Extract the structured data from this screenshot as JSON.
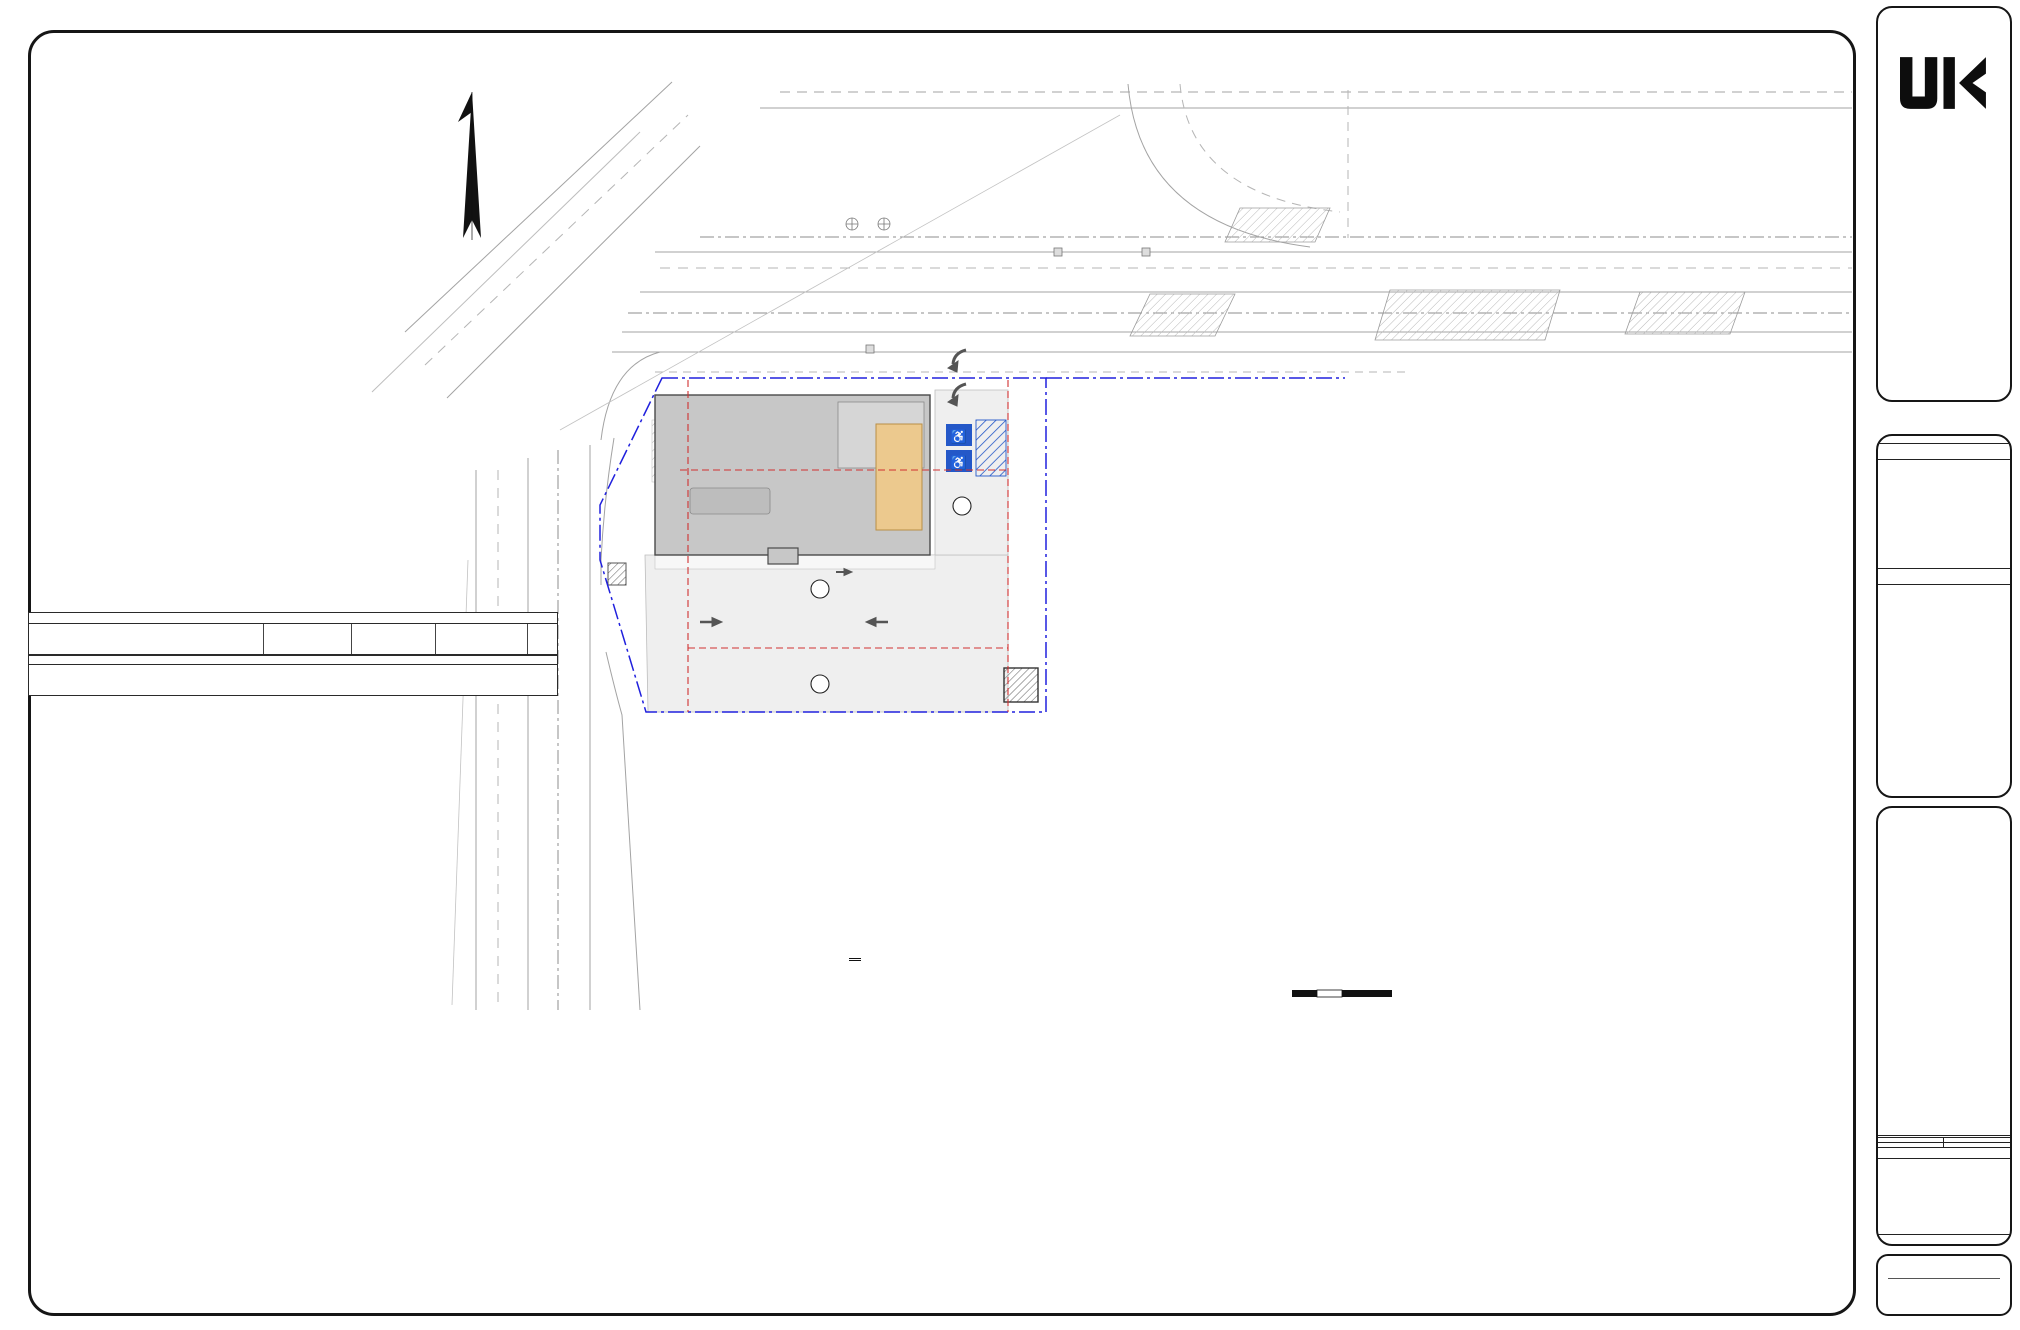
{
  "sheet": {
    "margin_note": "S:\\PROJECT\\KIRPAP21-332 667 E MILTON AVE RAHWAY, NJ\\CAD\\21-332 C-100 SITE EXHIBIT.DWG   PLOTTED: 10/7/2022 9:09 AM",
    "survey": {
      "title": "SURVEY REFERENCE:",
      "items": [
        "BOUNDARY & TOPOGRAPHY INFORMATION IS BASED ON A SURVEY TITLED \"BOUNDARY & TOPOGRAPHIC SURVEY OF 667 EAST MILTON AVENUE, LOT 3.02 IN BLOCK 338 ON TAX MAPS OF CITY OF RAHWAY, UNION COUNTY, NEW JERSEY, PREPARED FOR KIRPA PATEL\", BY PRONESTI SURVEYING, INC., 870 POMPTON AVENUE, SUITE B1, CEDAR GROVE, NJ 07009, DATED 2-14-2022, WITH NO REVISIONS.",
        "VERTICAL DATUM ARE BASED ON NAVD 83."
      ],
      "numbers": [
        "1.",
        "2."
      ]
    },
    "footer": {
      "title": "SCHEMATIC SITE PLAN",
      "scale": "SCALE: 1\"=20'",
      "scalebar": [
        "0",
        "10",
        "20",
        "40"
      ]
    }
  },
  "zoning": {
    "title": "ZONING SCHEDULE",
    "subtitle": "BLOCK 338, LOTS 3.02",
    "zone": "ZONE: B-3 District (Highway Business Zone)",
    "headers": {
      "bulk": "Bulk Regulation",
      "units": "Units",
      "req": "Requirement",
      "exist1": "Existing",
      "exist2": "Lot 3.02",
      "prop": "Proposed"
    },
    "rows": [
      {
        "l": "Principal Permitted Uses",
        "e": "Vacant Lot",
        "p": "Restaurant / Bar",
        "st": "C"
      },
      {
        "g": 1
      },
      {
        "l": "Min. Lot Area",
        "u": "Square Feet",
        "r": "30,000",
        "e": "29,807",
        "p": "29,807",
        "st": "ENC"
      },
      {
        "u": "Acres",
        "r": "0.689",
        "e": "0.684",
        "p": "0.684",
        "st": "-"
      },
      {
        "g": 1
      },
      {
        "l": "Min. Lot Width",
        "u": "Feet",
        "r": "100",
        "e": "150.00",
        "p": "150.00",
        "st": "C"
      },
      {
        "l": "Min. Lot Depth",
        "u": "Feet",
        "r": "200",
        "e": "200.00",
        "p": "200.00",
        "st": "C"
      },
      {
        "g": 1
      },
      {
        "l": "Principal Building (CORNER LOT)",
        "s": 1
      },
      {
        "l": "Min. Front Yard (East Milton Avenue)",
        "u": "Feet",
        "r": "40",
        "e": "-",
        "p": "5.00",
        "st": "V",
        "i": 1,
        "b": 1
      },
      {
        "l": "Min. Front Yard (Paterson Street)",
        "u": "Feet",
        "r": "40",
        "e": "-",
        "p": "25.00",
        "st": "V",
        "i": 1,
        "b": 1
      },
      {
        "l": "Min. Side Yard - One",
        "u": "Feet",
        "r": "20",
        "e": "-",
        "p": "N/A",
        "i": 1
      },
      {
        "l": "Min. Side Yard - Both",
        "u": "Feet",
        "r": "50",
        "e": "-",
        "p": "N/A",
        "i": 1
      },
      {
        "l": "Min. Rear Yard (East Milton Avenue)",
        "u": "Feet",
        "r": "25",
        "e": "-",
        "p": "70.98",
        "st": "C",
        "i": 1
      },
      {
        "l": "Min. Rear Yard (Paterson Street)",
        "u": "Feet",
        "r": "25",
        "e": "-",
        "p": "59.00",
        "st": "C",
        "i": 1
      },
      {
        "l": "Max. Height",
        "u": "Stories",
        "r": "2",
        "e": "-",
        "p": "1",
        "st": "C",
        "i": 1
      },
      {
        "l": "Max. Height",
        "u": "Feet",
        "r": "35",
        "e": "-",
        "p": "18.00",
        "st": "C",
        "i": 1
      },
      {
        "g": 1
      },
      {
        "l": "Accessory Structure (Trash Enclosure)",
        "s": 1
      },
      {
        "l": "Accessory Structure In Front Yard",
        "u": "-",
        "r": "Not Permitted",
        "e": "-",
        "p": "N/A",
        "i": 1
      },
      {
        "l": "Min. Side Yard",
        "u": "Feet",
        "r": "10",
        "e": "-",
        "p": "N/A",
        "i": 1
      },
      {
        "l": "Min. Rear Yard (East Milton Avenue)",
        "u": "Feet",
        "r": "10",
        "e": "-",
        "p": "4.97",
        "st": "V",
        "i": 1,
        "b": 1
      },
      {
        "l": "Min. Rear Yard (Paterson Street)",
        "u": "Feet",
        "r": "10",
        "e": "-",
        "p": "6.99",
        "st": "V",
        "i": 1,
        "b": 1
      },
      {
        "l": "Max. Height",
        "u": "Stories",
        "r": "1",
        "e": "-",
        "p": "1",
        "st": "C",
        "i": 1
      },
      {
        "l": "Max. Height",
        "u": "Feet",
        "r": "15",
        "e": "-",
        "p": "6.00",
        "st": "C",
        "i": 1
      },
      {
        "g": 1
      },
      {
        "l": "Max. Building Coverage",
        "u": "%",
        "r": "35",
        "e": "-",
        "p": "24.73",
        "st": "C"
      },
      {
        "g": 1
      },
      {
        "l": "Max. Impervious Coverage",
        "u": "%",
        "r": "80",
        "e": "-",
        "p": "80.38",
        "st": "V",
        "b": 1
      },
      {
        "g": 1
      },
      {
        "l": "Max. Floor Area Ratio",
        "u": "%",
        "r": "40",
        "e": "-",
        "p": "0.246",
        "st": "C"
      },
      {
        "g": 1
      },
      {
        "l": "Parking Required (2)",
        "r": "67",
        "p": "38",
        "st": "V",
        "b": 1
      }
    ],
    "abbr_title": "Abbreviations",
    "abbreviations": [
      [
        "C",
        "Conforms"
      ],
      [
        "ENC",
        "Existing Non Conformance"
      ],
      [
        "NR",
        "No Requirement"
      ],
      [
        "V",
        "Variance Required"
      ]
    ],
    "notes_title": "Notes:",
    "notes": [
      [
        "1",
        "Codes are based on City of Rahway, Ordinance Section - 421- Attachment 1."
      ],
      [
        "2",
        "Restaurants and eating and drinking establishments 1 per 3 seats, plus 1 per 2 seats in lounge or bar areas."
      ]
    ]
  },
  "titleblock": {
    "firm": {
      "name1": "Jarmel",
      "name2": "Kizel",
      "tag": "ARCHITECTS AND ENGINEERS INC.",
      "addr1": "42 OKNER PARKWAY",
      "addr2": "LIVINGSTON, NEW JERSEY 07039",
      "tel": "TEL: 973-994-9669",
      "fax": "FAX: 973-994-4069",
      "web": "www.jarmelkizel.com",
      "services": [
        "Architecture",
        "Engineering",
        "Interior Design",
        "Implementation Services"
      ],
      "auth1": "NJ State Board Of Architects Authorization No. 161",
      "auth2": "NJ State Board Of Engineers & Land Surveyors Authorization No. GA-278177"
    },
    "issue": {
      "title": "ISSUE",
      "cols": [
        "NO.",
        "DATE",
        "DESCRIPTION",
        "INT."
      ]
    },
    "revision": {
      "title": "REVISION",
      "cols": [
        "NO.",
        "DATE",
        "DESCRIPTION",
        "INT."
      ]
    },
    "principals": {
      "title": "PRINCIPALS",
      "names": [
        "MATTHEW B. JARMEL, AIA, MBA",
        "RICHARD A. JARMEL, PE",
        "IRWIN H. KIZEL, AIA, PP"
      ]
    },
    "architects": {
      "title": "ARCHITECTS & ENGINEERS",
      "names": [
        "RONALD A. BROKENSHIRE, PE",
        "JEROME LESLIE EBEN, FAIA, PP",
        "ARKADIUSZ ERIC CZERW, PE",
        "GERARD P. GESARIO, PE",
        "SAMEH IBRAHEEM, PE",
        "FREDERICK KINCAID, AIA",
        "DAVID L. LESESNE, RA",
        "KAROLINA PODKANOWICZ, AIA",
        "ROBERT B. RICHARDSON, AIA",
        "CHERYL SCHWEIKER, AIA"
      ]
    },
    "project": {
      "label": "Project:",
      "name": "AROOGA'S GRILLE HOUSE & SPORTS BAR",
      "lines": [
        "667 EAST MILTON AVENUE",
        "CITY OF RAHWAY",
        "UNION COUNTY, NEW JERSEY",
        "BLOCK 338, LOT 3.02"
      ]
    },
    "fields": {
      "pn_label": "Project Number:",
      "pn": "KIRPAP21-332",
      "scale_label": "Scale:",
      "scale": "1\" = 20'",
      "drawn_label": "Drawn By:",
      "drawn": "A.P.P.",
      "appr_label": "Approved By:",
      "appr": "G.P.G.",
      "dn_label": "Drawing Name:",
      "dn1": "SCHEMATIC SITE",
      "dn2": "PLAN",
      "dnum_label": "Drawing Number:",
      "dnum": "S-100",
      "sheet": "1 OF 1",
      "date_label": "Initial Date:",
      "date": "OCTOBER 04, 2022"
    },
    "engineer": {
      "title": "ENGINEER OF RECORD",
      "name": "GERARD P. GESARIO, PE",
      "lic": "NJ LIC. 24GE03825500"
    }
  },
  "plan": {
    "streets": {
      "hw1": "NEW JERSEY STATE HIGHWAY",
      "hw2": "(126.00' R.O.W.)",
      "em1": "EAST MILTON AVENUE",
      "em2": "(80.00' R.O.W.)",
      "ps1": "PATERSON STREET",
      "ps2": "(66.00' R.O.W.)"
    },
    "building": {
      "l1": "PROPOSED",
      "l2": "1-STORY BUILDING"
    },
    "setbacks": {
      "front": "FRONT YARD SET BACK",
      "rear": "REAR YARD SET BACK",
      "side": "SIDE YARD SET BACK",
      "suffix": "(SET BACK)"
    },
    "dims": {
      "d6899": "68.99'",
      "d2500": "25.00'",
      "d5900": "59.00'",
      "d7098": "70.98'",
      "d2400": "24.00'",
      "d1800": "18.00'",
      "d900": "9.00'",
      "d497": "4.97'",
      "d699": "6.99'",
      "typ": "(TYP.)"
    },
    "parking": {
      "p7": "7",
      "p15": "15",
      "p16": "16"
    },
    "utils": {
      "rcp48": "48\" RCP STORM MAIN",
      "rcp30": "30\" RCP STORM MAIN",
      "water4": "4\" WATER MAIN",
      "white": "SOLID WHITE LINE",
      "gas4": "4\" CAST IRON GAS MAIN",
      "yellow": "DOUBLE YELLOW LINE",
      "gas10": "10\" PLASTIC GAS MAIN (SURVEY RECORDS)",
      "gas4sr": "4\" CAST IRON GAS MAIN (SURVEY RECORDS)",
      "gas12": "12\" STEEL GAS MAIN (SURVEY RECORDS)",
      "pvc8": "8\" PVC SANITARY SEWER MAIN",
      "corr15": "15\" CORRUGATED PLASTIC PIPE",
      "tile12": "12\" TILE SANITARY SEWER MAIN",
      "water8": "8\" WATER MAIN (SURVEY RECORDS)",
      "crosswalk": "CROSS WALK",
      "stop": "STOP",
      "stopline": "STOP LINE",
      "only": "ONLY",
      "ohw": "OHW"
    },
    "catch_basins": [
      [
        "CB",
        "GRT 17.83",
        "INV 7.6"
      ],
      [
        "CB",
        "GRT 16.73",
        "INV(N) 6.4",
        "INV(S) 6.2",
        "INV(E) 12.7 (b.)"
      ],
      [
        "CB",
        "GRT 16.13",
        "INV(N) 5.9",
        "INV(S) 5.8 (b.)"
      ],
      [
        "CB",
        "GRT 15.93"
      ]
    ]
  }
}
